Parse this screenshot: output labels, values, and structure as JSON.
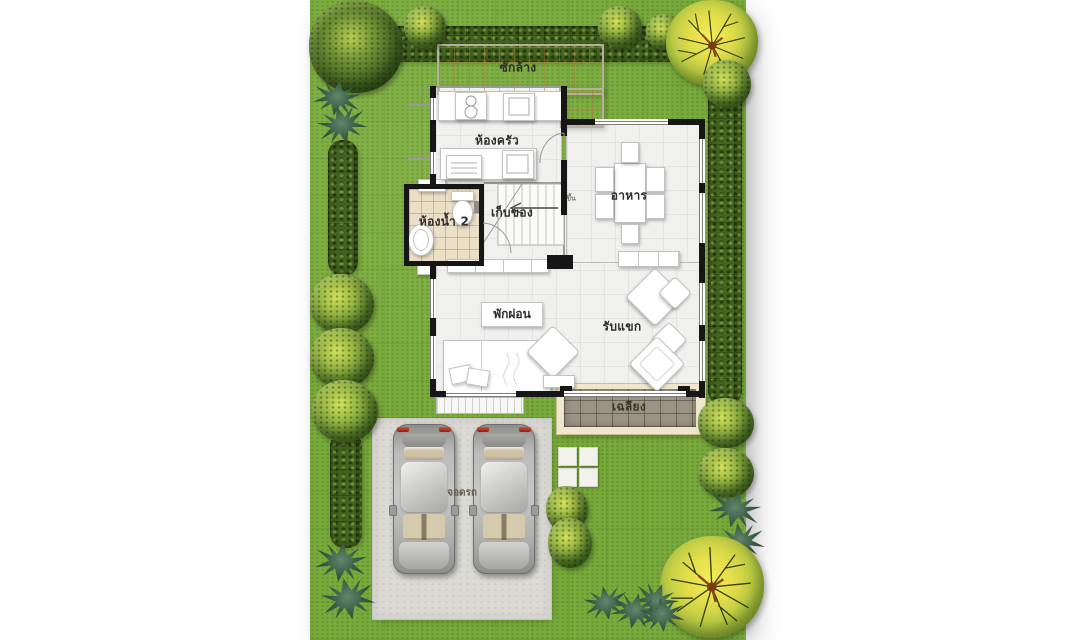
{
  "floorplan": {
    "rooms": {
      "laundry": "ซักล้าง",
      "kitchen": "ห้องครัว",
      "dining": "อาหาร",
      "storage": "เก็บของ",
      "bathroom2": "ห้องน้ำ 2",
      "stairs_up": "ขึ้น",
      "relax": "พักผ่อน",
      "living": "รับแขก",
      "porch": "เฉลียง",
      "parking": "จอดรถ"
    },
    "colors": {
      "grass": "#79ab3c",
      "hedge": "#44631f",
      "laundry_tile": "#ead9a9",
      "bathroom_tile": "#ebdfc6",
      "porch_tile": "#9b9384",
      "concrete": "#dbdad5",
      "wall": "#161616",
      "floor": "#f0f1ef",
      "tree_yellow": "#e3dd49"
    }
  }
}
